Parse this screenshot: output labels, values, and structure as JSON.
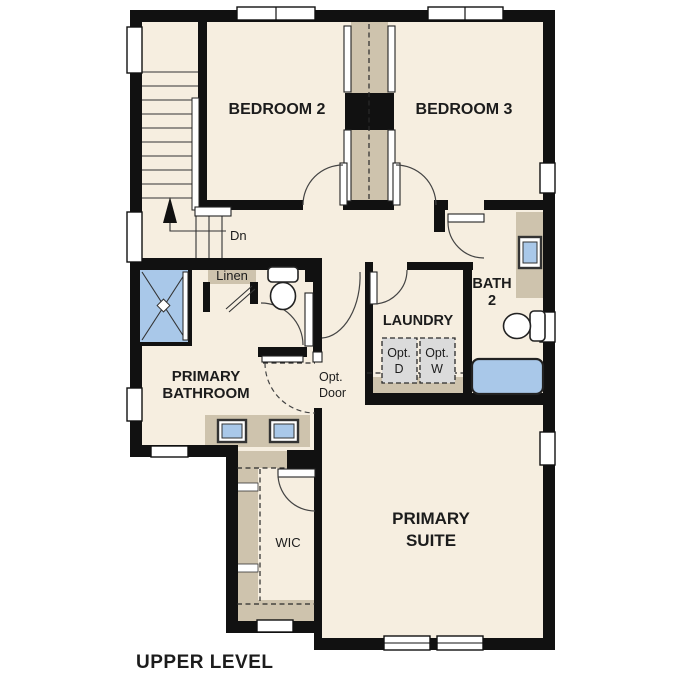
{
  "title": "UPPER LEVEL",
  "rooms": {
    "bedroom2": "BEDROOM 2",
    "bedroom3": "BEDROOM 3",
    "primary_bathroom": {
      "line1": "PRIMARY",
      "line2": "BATHROOM"
    },
    "laundry": "LAUNDRY",
    "bath2": {
      "line1": "BATH",
      "line2": "2"
    },
    "primary_suite": {
      "line1": "PRIMARY",
      "line2": "SUITE"
    },
    "wic": "WIC"
  },
  "annotations": {
    "stairs_direction": "Dn",
    "linen": "Linen",
    "optional_door": {
      "line1": "Opt.",
      "line2": "Door"
    },
    "optional_dryer": {
      "line1": "Opt.",
      "line2": "D"
    },
    "optional_washer": {
      "line1": "Opt.",
      "line2": "W"
    }
  },
  "colors": {
    "paper": "#ffffff",
    "floor": "#f6eee0",
    "wall": "#111111",
    "tan": "#cec3ad",
    "blue": "#a9c8e9",
    "gray": "#dbdbdb",
    "text": "#1c1c1c"
  }
}
